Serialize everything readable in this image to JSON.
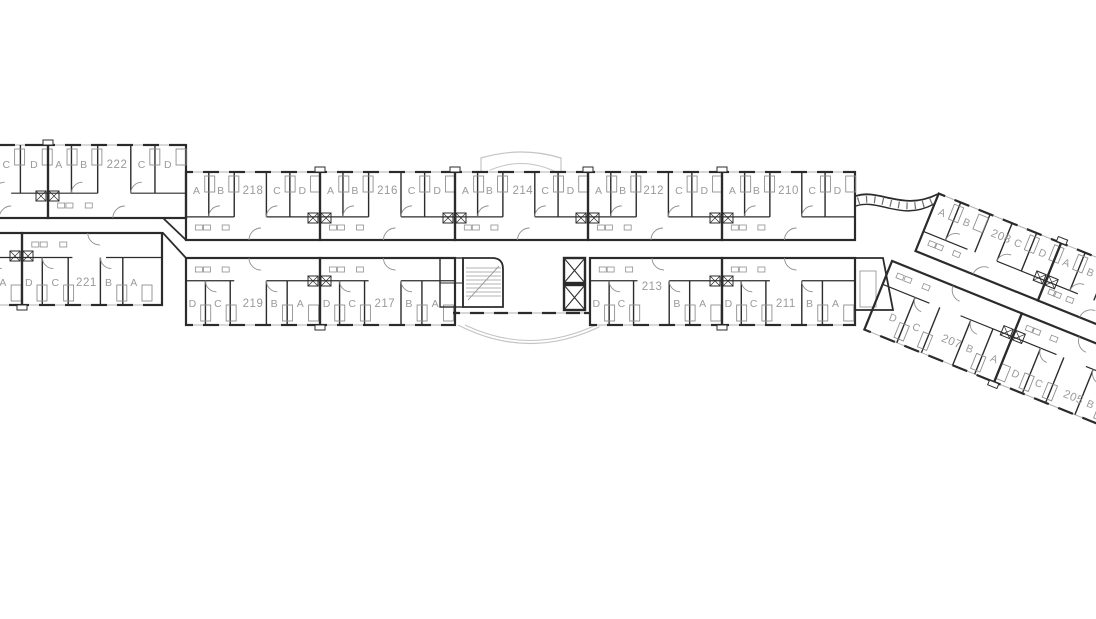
{
  "floorplan": {
    "colors": {
      "wall": "#2b2b2b",
      "label": "#9a9a9a",
      "detail": "#8f8f8f",
      "window": "#b0b0b0",
      "canopy": "#c4c4c4",
      "background": "#ffffff"
    },
    "bands": [
      {
        "id": "top-left",
        "y": 145,
        "h": 73,
        "side": "top",
        "labelY": 23,
        "units": [
          {
            "number": "",
            "x": -44,
            "w": 92,
            "partial": true,
            "divs": [
              0.41,
              0.7
            ],
            "letters": [
              [
                "C",
                0.55
              ],
              [
                "D",
                0.85
              ]
            ]
          },
          {
            "number": "222",
            "x": 48,
            "w": 138,
            "numf": 0.5,
            "divs": [
              0.17,
              0.36,
              0.6,
              0.775
            ],
            "letters": [
              [
                "A",
                0.08
              ],
              [
                "B",
                0.26
              ],
              [
                "C",
                0.68
              ],
              [
                "D",
                0.87
              ]
            ]
          }
        ]
      },
      {
        "id": "top-main",
        "y": 172,
        "h": 68,
        "side": "top",
        "labelY": 22,
        "units": [
          {
            "number": "218",
            "x": 186,
            "w": 134,
            "numf": 0.5,
            "divs": [
              0.17,
              0.36,
              0.6,
              0.775
            ],
            "letters": [
              [
                "A",
                0.08
              ],
              [
                "B",
                0.26
              ],
              [
                "C",
                0.68
              ],
              [
                "D",
                0.87
              ]
            ]
          },
          {
            "number": "216",
            "x": 320,
            "w": 135,
            "numf": 0.5,
            "divs": [
              0.17,
              0.36,
              0.6,
              0.775
            ],
            "letters": [
              [
                "A",
                0.08
              ],
              [
                "B",
                0.26
              ],
              [
                "C",
                0.68
              ],
              [
                "D",
                0.87
              ]
            ]
          },
          {
            "number": "214",
            "x": 455,
            "w": 133,
            "numf": 0.51,
            "divs": [
              0.17,
              0.36,
              0.6,
              0.775
            ],
            "letters": [
              [
                "A",
                0.08
              ],
              [
                "B",
                0.26
              ],
              [
                "C",
                0.68
              ],
              [
                "D",
                0.87
              ]
            ]
          },
          {
            "number": "212",
            "x": 588,
            "w": 134,
            "numf": 0.49,
            "divs": [
              0.17,
              0.36,
              0.6,
              0.775
            ],
            "letters": [
              [
                "A",
                0.08
              ],
              [
                "B",
                0.26
              ],
              [
                "C",
                0.68
              ],
              [
                "D",
                0.87
              ]
            ]
          },
          {
            "number": "210",
            "x": 722,
            "w": 133,
            "numf": 0.5,
            "divs": [
              0.17,
              0.36,
              0.6,
              0.775
            ],
            "letters": [
              [
                "A",
                0.08
              ],
              [
                "B",
                0.26
              ],
              [
                "C",
                0.68
              ],
              [
                "D",
                0.87
              ]
            ]
          }
        ]
      },
      {
        "id": "bottom-left",
        "y": 233,
        "h": 72,
        "side": "bottom",
        "labelY": 53,
        "units": [
          {
            "number": "",
            "x": -60,
            "w": 82,
            "partial": true,
            "divs": [
              0.62
            ],
            "letters": [
              [
                "A",
                0.77
              ]
            ]
          },
          {
            "number": "221",
            "x": 22,
            "w": 140,
            "numf": 0.46,
            "divs": [
              0.145,
              0.33,
              0.56,
              0.72
            ],
            "letters": [
              [
                "D",
                0.05
              ],
              [
                "C",
                0.24
              ],
              [
                "B",
                0.62
              ],
              [
                "A",
                0.8
              ]
            ]
          }
        ]
      },
      {
        "id": "bottom-main-west",
        "y": 258,
        "h": 67,
        "side": "bottom",
        "labelY": 49,
        "units": [
          {
            "number": "219",
            "x": 186,
            "w": 134,
            "numf": 0.5,
            "divs": [
              0.145,
              0.33,
              0.6,
              0.755
            ],
            "letters": [
              [
                "D",
                0.05
              ],
              [
                "C",
                0.24
              ],
              [
                "B",
                0.66
              ],
              [
                "A",
                0.855
              ]
            ]
          },
          {
            "number": "217",
            "x": 320,
            "w": 135,
            "numf": 0.48,
            "divs": [
              0.145,
              0.33,
              0.6,
              0.755
            ],
            "letters": [
              [
                "D",
                0.05
              ],
              [
                "C",
                0.24
              ],
              [
                "B",
                0.66
              ],
              [
                "A",
                0.855
              ]
            ]
          }
        ]
      },
      {
        "id": "bottom-main-east",
        "y": 258,
        "h": 67,
        "side": "bottom",
        "labelY": 49,
        "units": [
          {
            "number": "213",
            "x": 590,
            "w": 132,
            "numf": 0.47,
            "numdy": -17,
            "divs": [
              0.145,
              0.33,
              0.6,
              0.755
            ],
            "letters": [
              [
                "D",
                0.05
              ],
              [
                "C",
                0.24
              ],
              [
                "B",
                0.66
              ],
              [
                "A",
                0.855
              ]
            ]
          },
          {
            "number": "211",
            "x": 722,
            "w": 133,
            "numf": 0.48,
            "divs": [
              0.145,
              0.33,
              0.6,
              0.755
            ],
            "letters": [
              [
                "D",
                0.05
              ],
              [
                "C",
                0.24
              ],
              [
                "B",
                0.66
              ],
              [
                "A",
                0.855
              ]
            ]
          }
        ]
      }
    ],
    "wing": {
      "x": 902,
      "y": 183,
      "angle": 22,
      "bands": [
        {
          "id": "wing-top",
          "y": -4,
          "h": 62,
          "side": "top",
          "labelY": 20,
          "units": [
            {
              "number": "208",
              "x": 38,
              "w": 132,
              "numf": 0.56,
              "divs": [
                0.18,
                0.42,
                0.6,
                0.8
              ],
              "letters": [
                [
                  "A",
                  0.08
                ],
                [
                  "B",
                  0.28
                ],
                [
                  "C",
                  0.7
                ],
                [
                  "D",
                  0.9
                ]
              ]
            },
            {
              "number": "",
              "x": 170,
              "w": 96,
              "partial": true,
              "divs": [
                0.27,
                0.54
              ],
              "letters": [
                [
                  "A",
                  0.13
                ],
                [
                  "B",
                  0.4
                ]
              ]
            }
          ]
        },
        {
          "id": "wing-bottom",
          "y": 76,
          "h": 74,
          "side": "bottom",
          "labelY": 56,
          "units": [
            {
              "number": "207",
              "x": 20,
              "w": 140,
              "numf": 0.61,
              "divs": [
                0.25,
                0.44,
                0.68,
                0.85
              ],
              "letters": [
                [
                  "D",
                  0.16
                ],
                [
                  "C",
                  0.34
                ],
                [
                  "B",
                  0.75
                ],
                [
                  "A",
                  0.94
                ]
              ]
            },
            {
              "number": "205",
              "x": 160,
              "w": 132,
              "numf": 0.6,
              "dy": 6,
              "numdy": 6,
              "divs": [
                0.23,
                0.42,
                0.66,
                0.84
              ],
              "letters": [
                [
                  "D",
                  0.13
                ],
                [
                  "C",
                  0.32
                ],
                [
                  "B",
                  0.74
                ]
              ]
            }
          ]
        }
      ]
    }
  }
}
